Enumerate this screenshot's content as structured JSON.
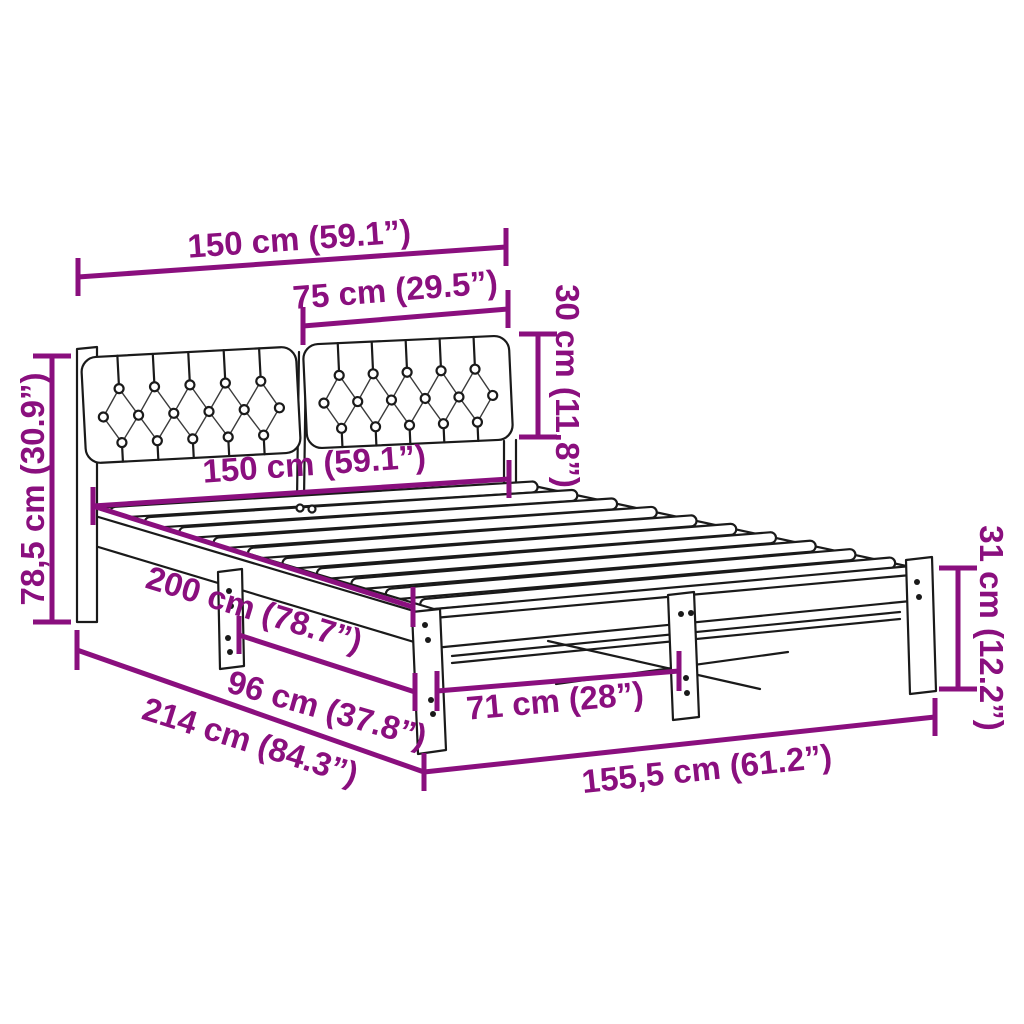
{
  "palette": {
    "dimension_color": "#8a0f7e",
    "line_color": "#1a1a1a",
    "background": "#ffffff"
  },
  "dimensions": {
    "headboard_width": "150 cm (59.1”)",
    "cushion_width": "75 cm (29.5”)",
    "cushion_height": "30 cm (11.8”)",
    "headboard_height": "78,5 cm (30.9”)",
    "bed_width": "150 cm (59.1”)",
    "bed_length": "200 cm (78.7”)",
    "support_leg_spacing": "96 cm (37.8”)",
    "foot_leg_spacing": "71 cm (28”)",
    "total_length": "214 cm (84.3”)",
    "total_width": "155,5 cm (61.2”)",
    "leg_height": "31 cm (12.2”)"
  }
}
